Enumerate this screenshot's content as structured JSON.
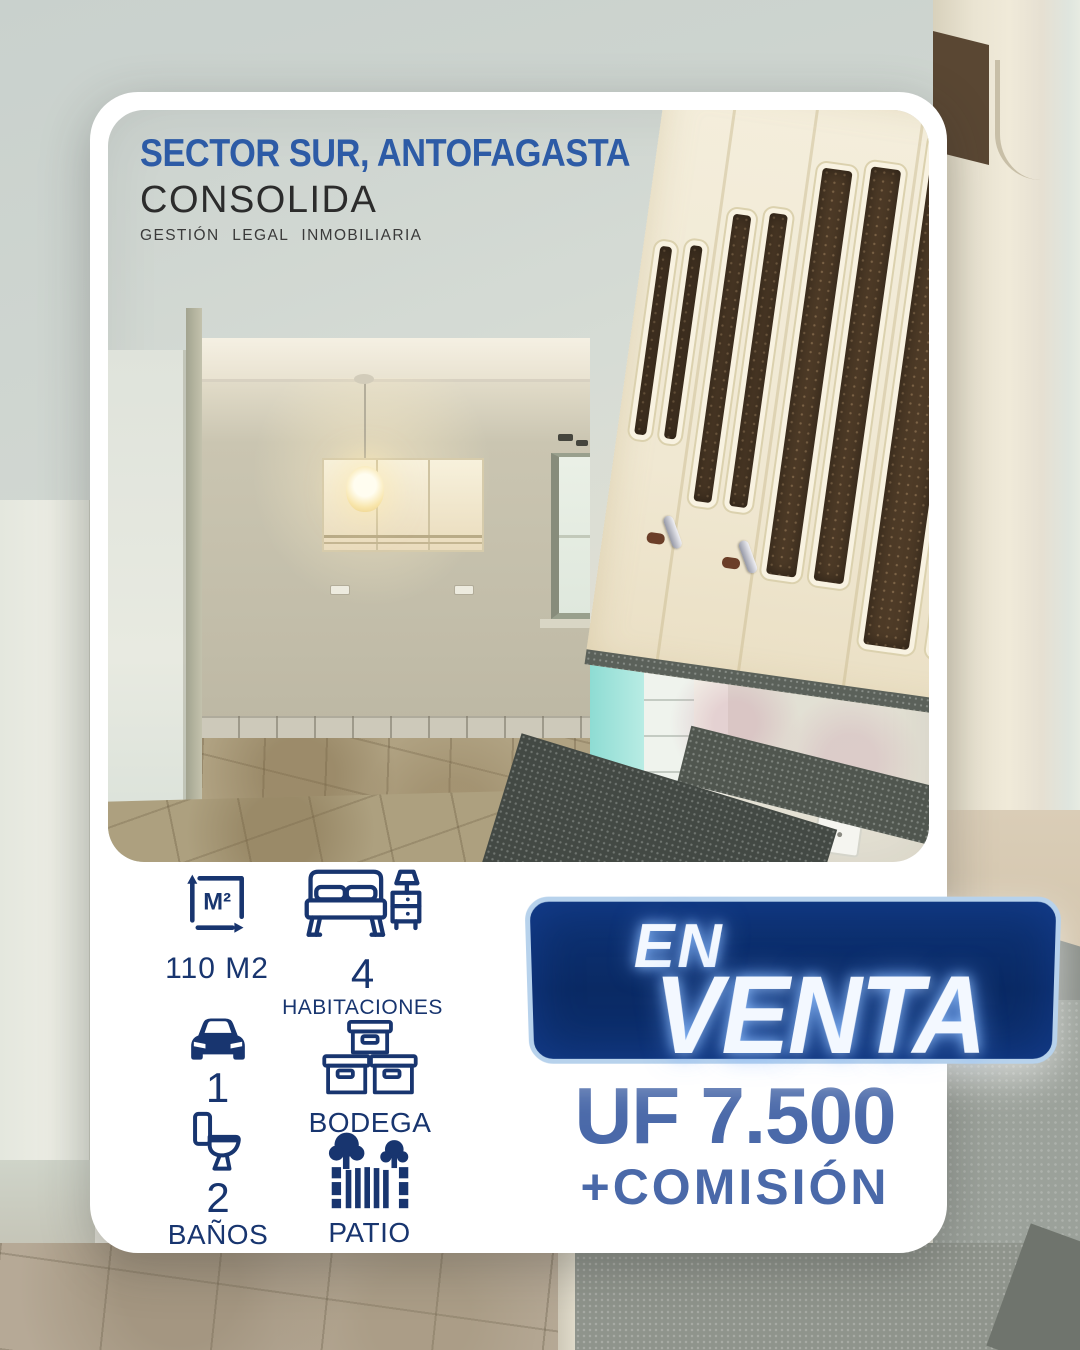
{
  "header": {
    "location": "SECTOR SUR, ANTOFAGASTA",
    "brand_name": "CONSOLIDA",
    "brand_tagline": "GESTIÓN LEGAL INMOBILIARIA"
  },
  "specs": {
    "area_value": "110 M2",
    "bedrooms_count": "4",
    "bedrooms_label": "HABITACIONES",
    "parking_count": "1",
    "storage_label": "BODEGA",
    "bathrooms_count": "2",
    "bathrooms_label": "BAÑOS",
    "patio_label": "PATIO"
  },
  "sale_banner": {
    "line1": "EN",
    "line2": "VENTA"
  },
  "price": {
    "amount": "UF 7.500",
    "commission": "+COMISIÓN"
  },
  "icons": {
    "area": "area-m2-icon",
    "area_glyph": "M²",
    "bedrooms": "bed-icon",
    "parking": "car-icon",
    "storage": "boxes-icon",
    "bathrooms": "toilet-icon",
    "patio": "fence-trees-icon"
  },
  "colors": {
    "navy_icons": "#18356f",
    "header_blue": "#2d5ba6",
    "price_blue": "#4a69a9",
    "banner_navy": "#0a2a64",
    "banner_border": "#b7d2ec",
    "card_white": "#ffffff"
  }
}
